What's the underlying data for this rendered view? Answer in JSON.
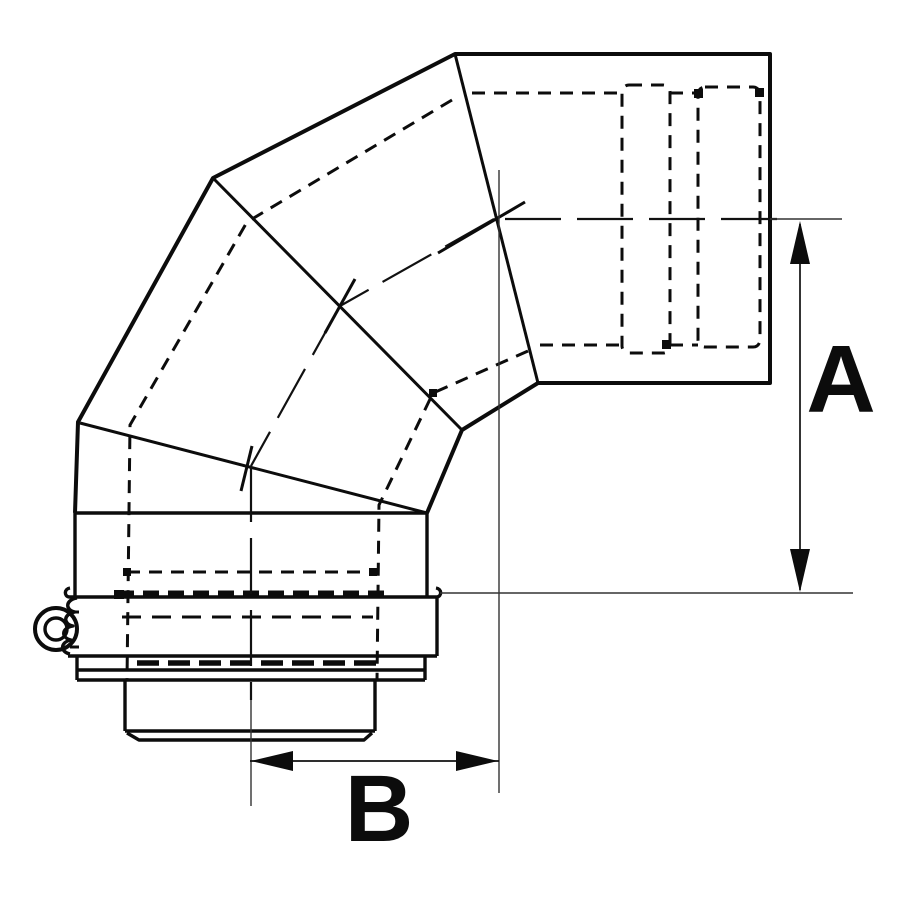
{
  "page": {
    "background_color": "#ffffff",
    "line_color": "#0c0c0c"
  },
  "drawing": {
    "type": "technical-line-drawing",
    "subject": "90-degree segmented flue elbow with locking band clamp; socket end at top right, spigot end at bottom; hidden inner liner shown dashed",
    "dimensions": {
      "a_label": "A",
      "b_label": "B"
    }
  }
}
